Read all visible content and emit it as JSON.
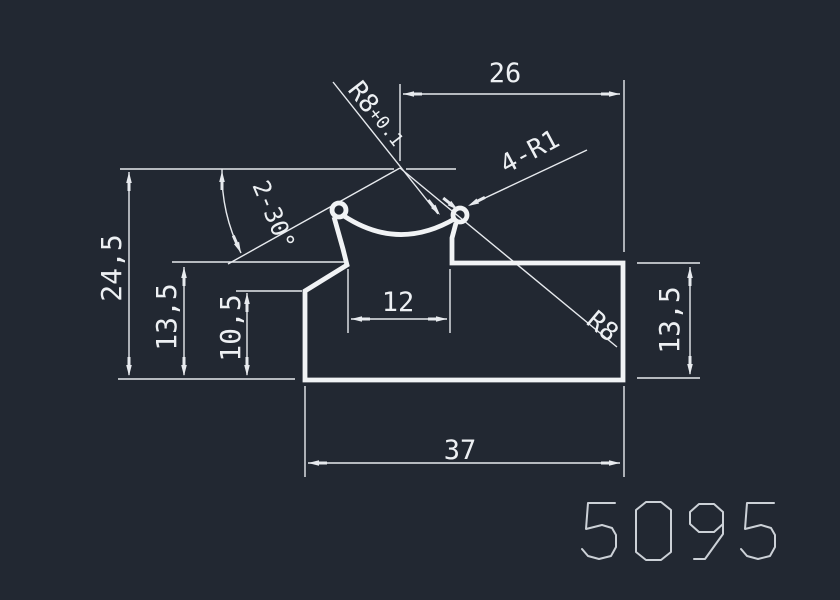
{
  "app": {
    "kind": "cad-drawing-view",
    "part_number": "5095"
  },
  "colors": {
    "background": "#222832",
    "line": "#f1f3f5",
    "thin": "#e7eaee",
    "text": "#edf0f3",
    "part_number": "#ccd1d7"
  },
  "dimensions": {
    "width_total": "37",
    "width_top": "26",
    "slot_width": "12",
    "height_total": "24,5",
    "height_shoulder_left": "13,5",
    "height_step_left": "10,5",
    "height_shoulder_right": "13,5",
    "radius_groove_tol": "R8+0.1",
    "radius_groove": "R8",
    "radius_lips": "4-R1",
    "angle_chamfer": "2-30°"
  },
  "drawing": {
    "profile": {
      "outline_path": "M 334 217 L 343 249 L 347 265 L 305 291 L 305 380 L 623 380 L 623 263 L 452 263 L 452 238 L 456 223",
      "groove_arc_path": "M 344 216 Q 399 252 456 218",
      "stroke_width": 4.8,
      "curls": [
        {
          "name": "left-lip-curl",
          "cx": 339,
          "cy": 210,
          "r": 7
        },
        {
          "name": "right-lip-curl",
          "cx": 460,
          "cy": 215,
          "r": 7
        }
      ]
    },
    "thin_lines": [
      [
        120,
        169,
        394,
        169
      ],
      [
        406,
        169,
        456,
        169
      ],
      [
        400,
        84,
        400,
        161
      ],
      [
        624,
        80,
        624,
        252
      ],
      [
        118,
        379,
        295,
        379
      ],
      [
        172,
        262,
        345,
        262
      ],
      [
        236,
        291,
        302,
        291
      ],
      [
        637,
        263,
        700,
        263
      ],
      [
        637,
        378,
        700,
        378
      ],
      [
        348,
        269,
        348,
        333
      ],
      [
        450,
        269,
        450,
        333
      ],
      [
        305,
        386,
        305,
        477
      ],
      [
        624,
        386,
        624,
        477
      ],
      [
        129,
        172,
        129,
        375
      ],
      [
        184,
        267,
        184,
        375
      ],
      [
        247,
        293,
        247,
        375
      ],
      [
        690,
        267,
        690,
        374
      ],
      [
        403,
        94,
        620,
        94
      ],
      [
        351,
        319,
        447,
        319
      ],
      [
        308,
        463,
        620,
        463
      ],
      [
        333,
        82,
        438,
        214
      ],
      [
        400,
        168,
        617,
        347
      ],
      [
        400,
        168,
        228,
        264
      ],
      [
        587,
        150,
        470,
        205
      ]
    ],
    "angle_arc_path": "M 222 169 A 178 178 0 0 0 241 253",
    "arrows": [
      {
        "x": 129,
        "y": 172,
        "a": -90
      },
      {
        "x": 129,
        "y": 376,
        "a": 90
      },
      {
        "x": 184,
        "y": 267,
        "a": -90
      },
      {
        "x": 184,
        "y": 376,
        "a": 90
      },
      {
        "x": 247,
        "y": 293,
        "a": -90
      },
      {
        "x": 247,
        "y": 376,
        "a": 90
      },
      {
        "x": 690,
        "y": 267,
        "a": -90
      },
      {
        "x": 690,
        "y": 375,
        "a": 90
      },
      {
        "x": 403,
        "y": 94,
        "a": 180
      },
      {
        "x": 620,
        "y": 94,
        "a": 0
      },
      {
        "x": 351,
        "y": 319,
        "a": 180
      },
      {
        "x": 447,
        "y": 319,
        "a": 0
      },
      {
        "x": 308,
        "y": 463,
        "a": 180
      },
      {
        "x": 620,
        "y": 463,
        "a": 0
      },
      {
        "x": 440,
        "y": 215,
        "a": 52
      },
      {
        "x": 458,
        "y": 210,
        "a": 39
      },
      {
        "x": 468,
        "y": 206,
        "a": 153
      },
      {
        "x": 222,
        "y": 171,
        "a": -90
      },
      {
        "x": 241,
        "y": 253,
        "a": 66
      }
    ],
    "labels": [
      {
        "id": "dim-26",
        "bind": "dimensions.width_top",
        "x": 505,
        "y": 82,
        "rot": 0,
        "size": 27,
        "anchor": "middle"
      },
      {
        "id": "dim-24-5",
        "bind": "dimensions.height_total",
        "x": 121,
        "y": 268,
        "rot": -90,
        "size": 28,
        "anchor": "middle"
      },
      {
        "id": "dim-13-5-left",
        "bind": "dimensions.height_shoulder_left",
        "x": 176,
        "y": 317,
        "rot": -90,
        "size": 28,
        "anchor": "middle"
      },
      {
        "id": "dim-10-5",
        "bind": "dimensions.height_step_left",
        "x": 240,
        "y": 328,
        "rot": -90,
        "size": 28,
        "anchor": "middle"
      },
      {
        "id": "dim-12",
        "bind": "dimensions.slot_width",
        "x": 398,
        "y": 311,
        "rot": 0,
        "size": 27,
        "anchor": "middle"
      },
      {
        "id": "dim-37",
        "bind": "dimensions.width_total",
        "x": 460,
        "y": 459,
        "rot": 0,
        "size": 27,
        "anchor": "middle"
      },
      {
        "id": "dim-13-5-right",
        "bind": "dimensions.height_shoulder_right",
        "x": 679,
        "y": 320,
        "rot": -90,
        "size": 28,
        "anchor": "middle"
      },
      {
        "id": "dim-4-r1",
        "bind": "dimensions.radius_lips",
        "x": 506,
        "y": 174,
        "rot": -28,
        "size": 26,
        "anchor": "start"
      },
      {
        "id": "dim-r8",
        "bind": "dimensions.radius_groove",
        "x": 585,
        "y": 323,
        "rot": 40,
        "size": 26,
        "anchor": "start"
      },
      {
        "id": "dim-2-30",
        "bind": "dimensions.angle_chamfer",
        "x": 252,
        "y": 185,
        "rot": 67,
        "size": 24,
        "anchor": "start"
      }
    ],
    "label_r8_tol": {
      "id": "dim-r8-tol",
      "main": "R8",
      "tol": "+0.1",
      "x": 347,
      "y": 90,
      "rot": 52,
      "size_main": 26,
      "size_tol": 18
    }
  },
  "part_number_glyphs": {
    "value": "5095",
    "x": 582,
    "y": 502,
    "advance": 53,
    "stroke_width": 2,
    "strokes": {
      "5": [
        [
          [
            33,
            1
          ],
          [
            6,
            1
          ],
          [
            4,
            27
          ],
          [
            20,
            23
          ],
          [
            30,
            26
          ],
          [
            34,
            33
          ],
          [
            34,
            45
          ],
          [
            29,
            54
          ],
          [
            17,
            57
          ],
          [
            6,
            54
          ],
          [
            0,
            47
          ]
        ]
      ],
      "0": [
        [
          [
            11,
            0
          ],
          [
            26,
            0
          ],
          [
            36,
            8
          ],
          [
            36,
            50
          ],
          [
            26,
            58
          ],
          [
            11,
            58
          ],
          [
            1,
            50
          ],
          [
            1,
            8
          ],
          [
            11,
            0
          ]
        ]
      ],
      "9": [
        [
          [
            35,
            10
          ],
          [
            26,
            2
          ],
          [
            11,
            2
          ],
          [
            2,
            10
          ],
          [
            2,
            22
          ],
          [
            11,
            30
          ],
          [
            26,
            30
          ],
          [
            35,
            22
          ],
          [
            35,
            10
          ]
        ],
        [
          [
            35,
            16
          ],
          [
            35,
            32
          ],
          [
            17,
            57
          ],
          [
            6,
            57
          ]
        ]
      ]
    }
  }
}
